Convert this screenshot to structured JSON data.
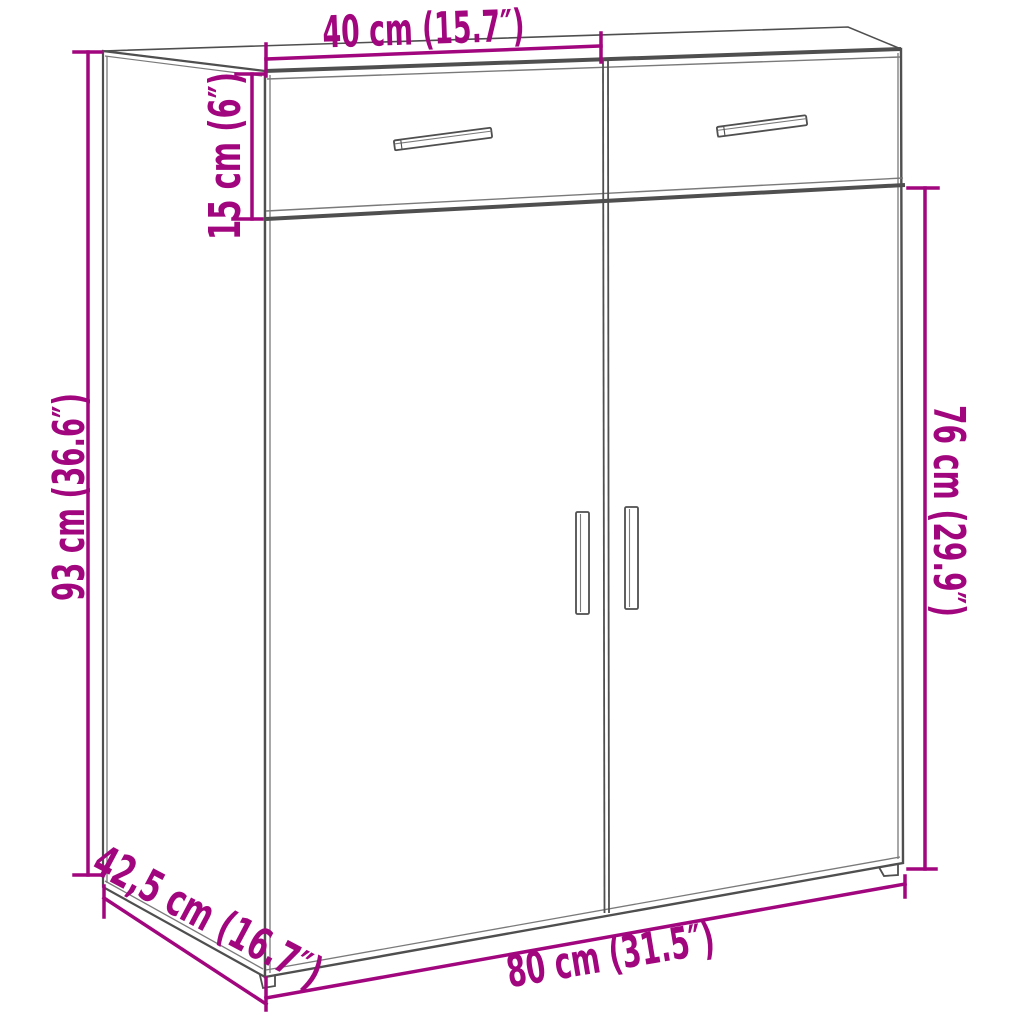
{
  "diagram": {
    "title": "sideboard-dimension-diagram",
    "product": "Sideboard cabinet with 2 drawers and 2 doors",
    "colors": {
      "dimension_accent": "#a1067e",
      "outline_gray": "#4f4f4f",
      "background": "#ffffff"
    },
    "dimensions": {
      "top_width": {
        "label": "40 cm (15.7″)",
        "cm": "40",
        "inches": "15.7"
      },
      "drawer_height": {
        "label": "15 cm (6″)",
        "cm": "15",
        "inches": "6"
      },
      "total_height": {
        "label": "93 cm (36.6″)",
        "cm": "93",
        "inches": "36.6"
      },
      "door_height": {
        "label": "76 cm (29.9″)",
        "cm": "76",
        "inches": "29.9"
      },
      "depth": {
        "label": "42,5 cm (16.7″)",
        "cm": "42,5",
        "inches": "16.7"
      },
      "total_width": {
        "label": "80 cm (31.5″)",
        "cm": "80",
        "inches": "31.5"
      }
    }
  }
}
